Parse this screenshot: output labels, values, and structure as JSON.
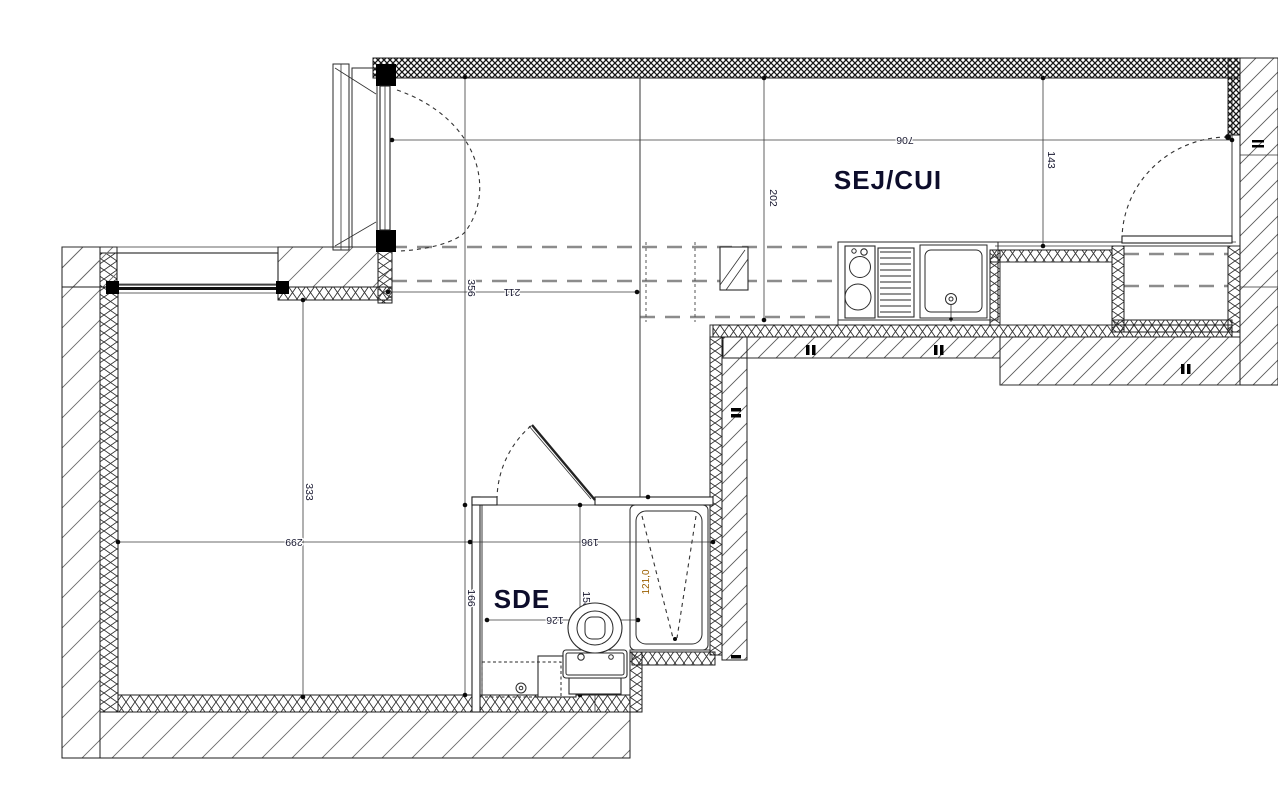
{
  "plan": {
    "title": "studio-apartment-floor-plan",
    "rooms": {
      "sej_cui": "SEJ/CUI",
      "sde": "SDE"
    },
    "dims": {
      "d706": "706",
      "d143": "143",
      "d202": "202",
      "d211": "211",
      "d356": "356",
      "d333": "333",
      "d299": "299",
      "d196": "196",
      "d166": "166",
      "d126": "126",
      "d158": "158",
      "shower_level": "121,0"
    },
    "colors": {
      "ink": "#1c1c1c",
      "ceiling_dash": "#8c8c8c",
      "shower_annotation": "#9a5f00"
    },
    "fixtures": {
      "toilet": "WC",
      "shower": "shower-tray",
      "washbasin": "washbasin",
      "sink": "kitchen-sink",
      "cooktop": "two-burner-cooktop",
      "drainer": "drainboard",
      "duct": "service-duct"
    }
  }
}
